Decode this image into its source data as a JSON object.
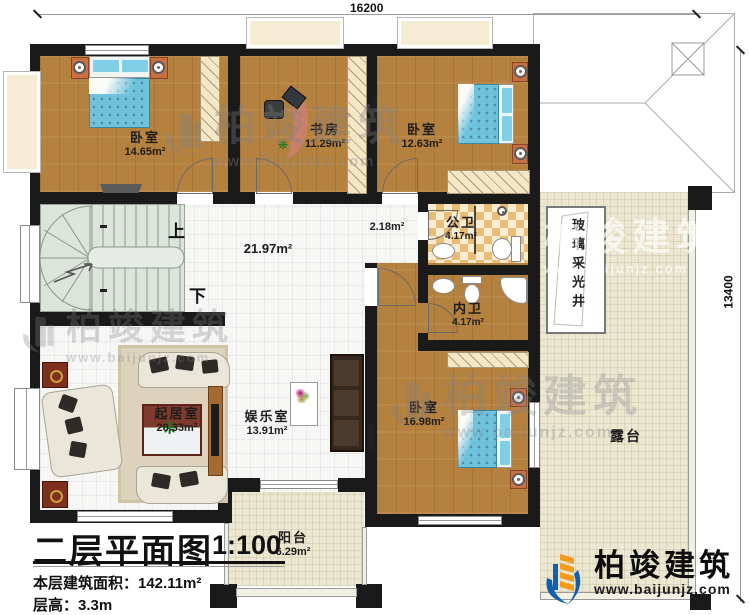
{
  "dimensions": {
    "top": "16200",
    "right": "13400"
  },
  "stairs": {
    "up": "上",
    "down": "下"
  },
  "rooms": {
    "bedroom1": {
      "name": "卧室",
      "area": "14.65m²"
    },
    "study": {
      "name": "书房",
      "area": "11.29m²"
    },
    "bedroom2": {
      "name": "卧室",
      "area": "12.63m²"
    },
    "hall": {
      "area": "21.97m²"
    },
    "corridor": {
      "area": "2.18m²"
    },
    "public_bath": {
      "name": "公卫",
      "area": "4.17m²"
    },
    "private_bath": {
      "name": "内卫",
      "area": "4.17m²"
    },
    "bedroom3": {
      "name": "卧室",
      "area": "16.98m²"
    },
    "living": {
      "name": "起居室",
      "area": "20.33m²"
    },
    "entertainment": {
      "name": "娱乐室",
      "area": "13.91m²"
    },
    "balcony": {
      "name": "阳台",
      "area": "6.29m²"
    },
    "terrace": {
      "name": "露台"
    },
    "lightwell": {
      "name": "玻璃采光井"
    }
  },
  "title_block": {
    "title": "二层平面图",
    "scale": "1:100",
    "area_line": "本层建筑面积：142.11m²",
    "height_line": "层高：3.3m"
  },
  "logo": {
    "brand": "柏竣建筑",
    "url": "www.baijunjz.com"
  },
  "watermark": {
    "brand": "柏竣建筑",
    "url": "www.baijunjz.com"
  },
  "colors": {
    "wall": "#1a1a1a",
    "wood": "#b5813f",
    "tile": "#f6f7f5",
    "bath_tile": "#e7bd76",
    "terrace": "#ebe7d1",
    "stair": "#dce4dc",
    "bed": "#6fc3dc",
    "logo_blue": "#1060ae",
    "logo_orange": "#f59a1d"
  }
}
